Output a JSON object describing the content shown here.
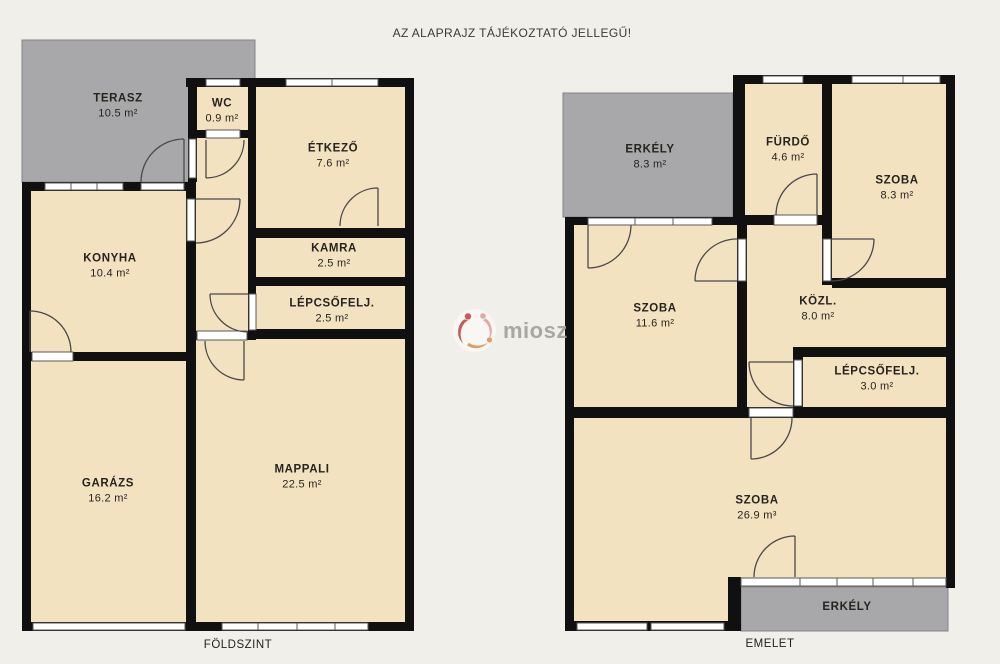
{
  "title": "AZ ALAPRAJZ TÁJÉKOZTATÓ JELLEGŰ!",
  "watermark": {
    "text": "miosz"
  },
  "colors": {
    "background": "#f1efe9",
    "room_fill": "#f3e2c0",
    "terrace_fill": "#a8a8aa",
    "wall": "#101010",
    "opening": "#ffffff",
    "label_text": "#26241f",
    "logo_red": "#c4504e",
    "logo_pink": "#e3a49e",
    "logo_orange": "#dc9760",
    "logo_text_gray": "#a3a19c"
  },
  "floors": {
    "ground": {
      "caption": "FÖLDSZINT",
      "rooms": {
        "terasz": {
          "name": "TERASZ",
          "area": "10.5 m²"
        },
        "wc": {
          "name": "WC",
          "area": "0.9 m²"
        },
        "etkezo": {
          "name": "ÉTKEZŐ",
          "area": "7.6 m²"
        },
        "konyha": {
          "name": "KONYHA",
          "area": "10.4 m²"
        },
        "kamra": {
          "name": "KAMRA",
          "area": "2.5 m²"
        },
        "lepcsofelj": {
          "name": "LÉPCSŐFELJ.",
          "area": "2.5 m²"
        },
        "garazs": {
          "name": "GARÁZS",
          "area": "16.2 m²"
        },
        "mappali": {
          "name": "MAPPALI",
          "area": "22.5 m²"
        }
      }
    },
    "upper": {
      "caption": "EMELET",
      "rooms": {
        "erkely_top": {
          "name": "ERKÉLY",
          "area": "8.3 m²"
        },
        "furdo": {
          "name": "FÜRDŐ",
          "area": "4.6 m²"
        },
        "szoba_small": {
          "name": "SZOBA",
          "area": "8.3 m²"
        },
        "szoba_mid": {
          "name": "SZOBA",
          "area": "11.6 m²"
        },
        "kozl": {
          "name": "KÖZL.",
          "area": "8.0 m²"
        },
        "lepcsofelj": {
          "name": "LÉPCSŐFELJ.",
          "area": "3.0 m²"
        },
        "szoba_big": {
          "name": "SZOBA",
          "area": "26.9 m³"
        },
        "erkely_bottom": {
          "name": "ERKÉLY"
        }
      }
    }
  }
}
